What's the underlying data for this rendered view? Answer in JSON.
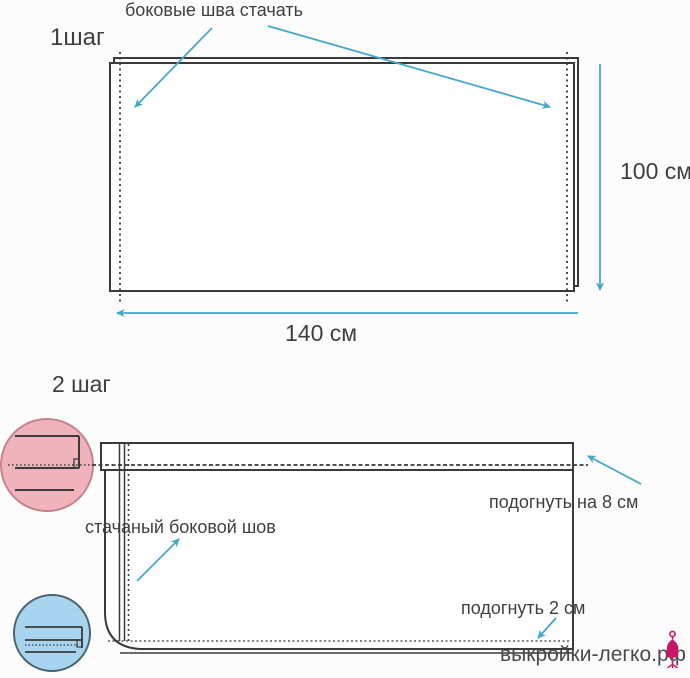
{
  "step1": {
    "heading": "1шаг",
    "seam_label": "боковые шва стачать",
    "height_label": "100 см",
    "width_label": "140 см"
  },
  "step2": {
    "heading": "2 шаг",
    "fold_top_label": "подогнуть на 8 см",
    "side_seam_label": "стачаный боковой шов",
    "fold_bottom_label": "подогнуть 2 см"
  },
  "watermark": {
    "site": "выкройки-легко.рф"
  },
  "icons": {
    "dress_form": "dress-form-icon",
    "arrows": "arrow-pointer-icon"
  },
  "colors": {
    "arrow_blue": "#45a8c9",
    "line_dark": "#3a3a3a",
    "pink_circle_fill": "#f1b3bb",
    "pink_circle_border": "#c2848e",
    "blue_circle_fill": "#a9d4f0",
    "blue_circle_border": "#4a6472",
    "watermark_gray": "#4a4a4a",
    "brand_magenta": "#cb1566",
    "background": "#fcfcfc"
  }
}
